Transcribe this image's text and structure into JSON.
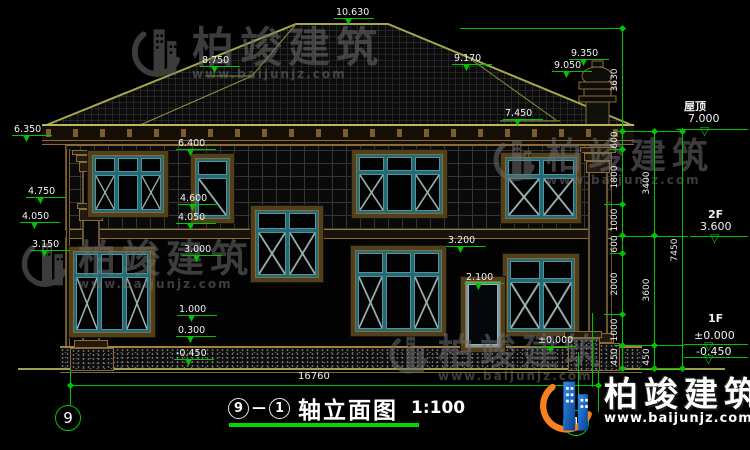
{
  "title": {
    "axis_from": "9",
    "separator": "—",
    "axis_to": "1",
    "name": "轴立面图",
    "scale": "1:100"
  },
  "axis_bubbles": {
    "left": "9",
    "right": "1"
  },
  "total_width_dim": "16760",
  "watermark": {
    "brand": "柏竣建筑",
    "url": "www.baijunjz.com"
  },
  "right_levels": [
    {
      "label": "屋顶",
      "value": "7.000"
    },
    {
      "label": "2F",
      "value": "3.600"
    },
    {
      "label": "1F",
      "value": "±0.000",
      "value_below": "-0.450"
    }
  ],
  "annotations": {
    "spot_markers": [
      {
        "value": "10.630",
        "x": 334,
        "y": 7
      },
      {
        "value": "8.750",
        "x": 200,
        "y": 55
      },
      {
        "value": "9.170",
        "x": 452,
        "y": 53
      },
      {
        "value": "9.350",
        "x": 569,
        "y": 48
      },
      {
        "value": "9.050",
        "x": 552,
        "y": 60
      },
      {
        "value": "7.450",
        "x": 503,
        "y": 108
      },
      {
        "value": "6.350",
        "x": 12,
        "y": 124
      },
      {
        "value": "6.400",
        "x": 176,
        "y": 138
      },
      {
        "value": "4.750",
        "x": 26,
        "y": 186
      },
      {
        "value": "4.050",
        "x": 20,
        "y": 211
      },
      {
        "value": "3.150",
        "x": 30,
        "y": 239
      },
      {
        "value": "4.600",
        "x": 178,
        "y": 193
      },
      {
        "value": "4.050",
        "x": 176,
        "y": 212
      },
      {
        "value": "3.000",
        "x": 182,
        "y": 244
      },
      {
        "value": "1.000",
        "x": 177,
        "y": 304
      },
      {
        "value": "0.300",
        "x": 176,
        "y": 325
      },
      {
        "value": "-0.450",
        "x": 174,
        "y": 348
      },
      {
        "value": "3.200",
        "x": 446,
        "y": 235
      },
      {
        "value": "2.100",
        "x": 464,
        "y": 272
      },
      {
        "value": "±0.000",
        "x": 536,
        "y": 335
      }
    ],
    "dim_chains": [
      {
        "x": 622,
        "boundaries": [
          28,
          131,
          149,
          204,
          235,
          253,
          314,
          345,
          368
        ],
        "labels": [
          "3630",
          "600",
          "1800",
          "1000",
          "600",
          "2000",
          "1000",
          "450"
        ]
      },
      {
        "x": 654,
        "boundaries": [
          131,
          235,
          345,
          368
        ],
        "labels": [
          "3400",
          "3600",
          "450"
        ]
      },
      {
        "x": 682,
        "boundaries": [
          131,
          368
        ],
        "labels": [
          "7450"
        ]
      }
    ]
  }
}
